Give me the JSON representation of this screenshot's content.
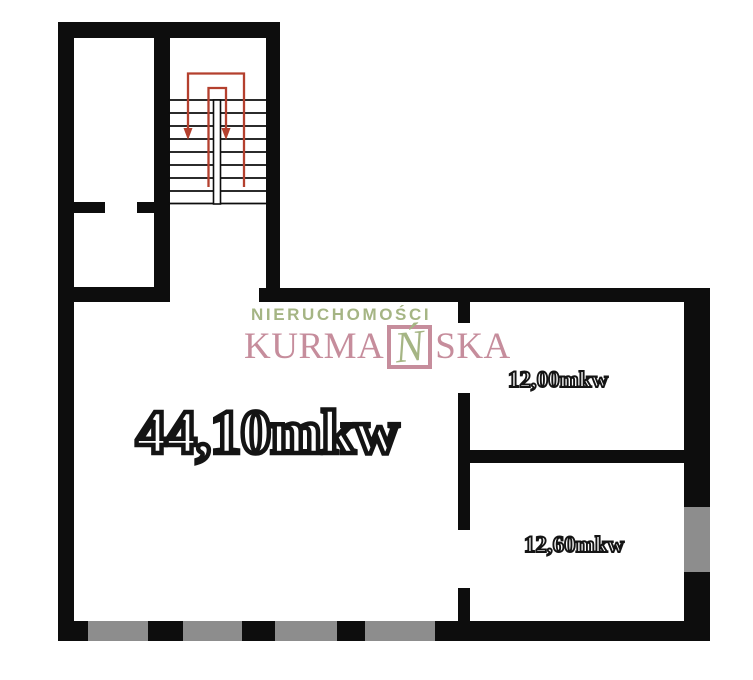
{
  "watermark": {
    "line1": "NIERUCHOMOŚCI",
    "brand_prefix": "KURMA",
    "brand_boxed_letter": "Ń",
    "brand_suffix": "SKA"
  },
  "rooms": {
    "main": {
      "area": "44,10mkw"
    },
    "top_right": {
      "area": "12,00mkw"
    },
    "bottom_right": {
      "area": "12,60mkw"
    }
  },
  "stairs": {
    "tread_count": 8,
    "direction_arrows": 2
  },
  "colors": {
    "wall_black": "#0d0d0d",
    "window_gray": "#8d8d8d",
    "stair_arrow_red": "#b4402e",
    "logo_green": "#a5b584",
    "logo_pink": "#c68d9c",
    "label_ink": "#141414"
  }
}
